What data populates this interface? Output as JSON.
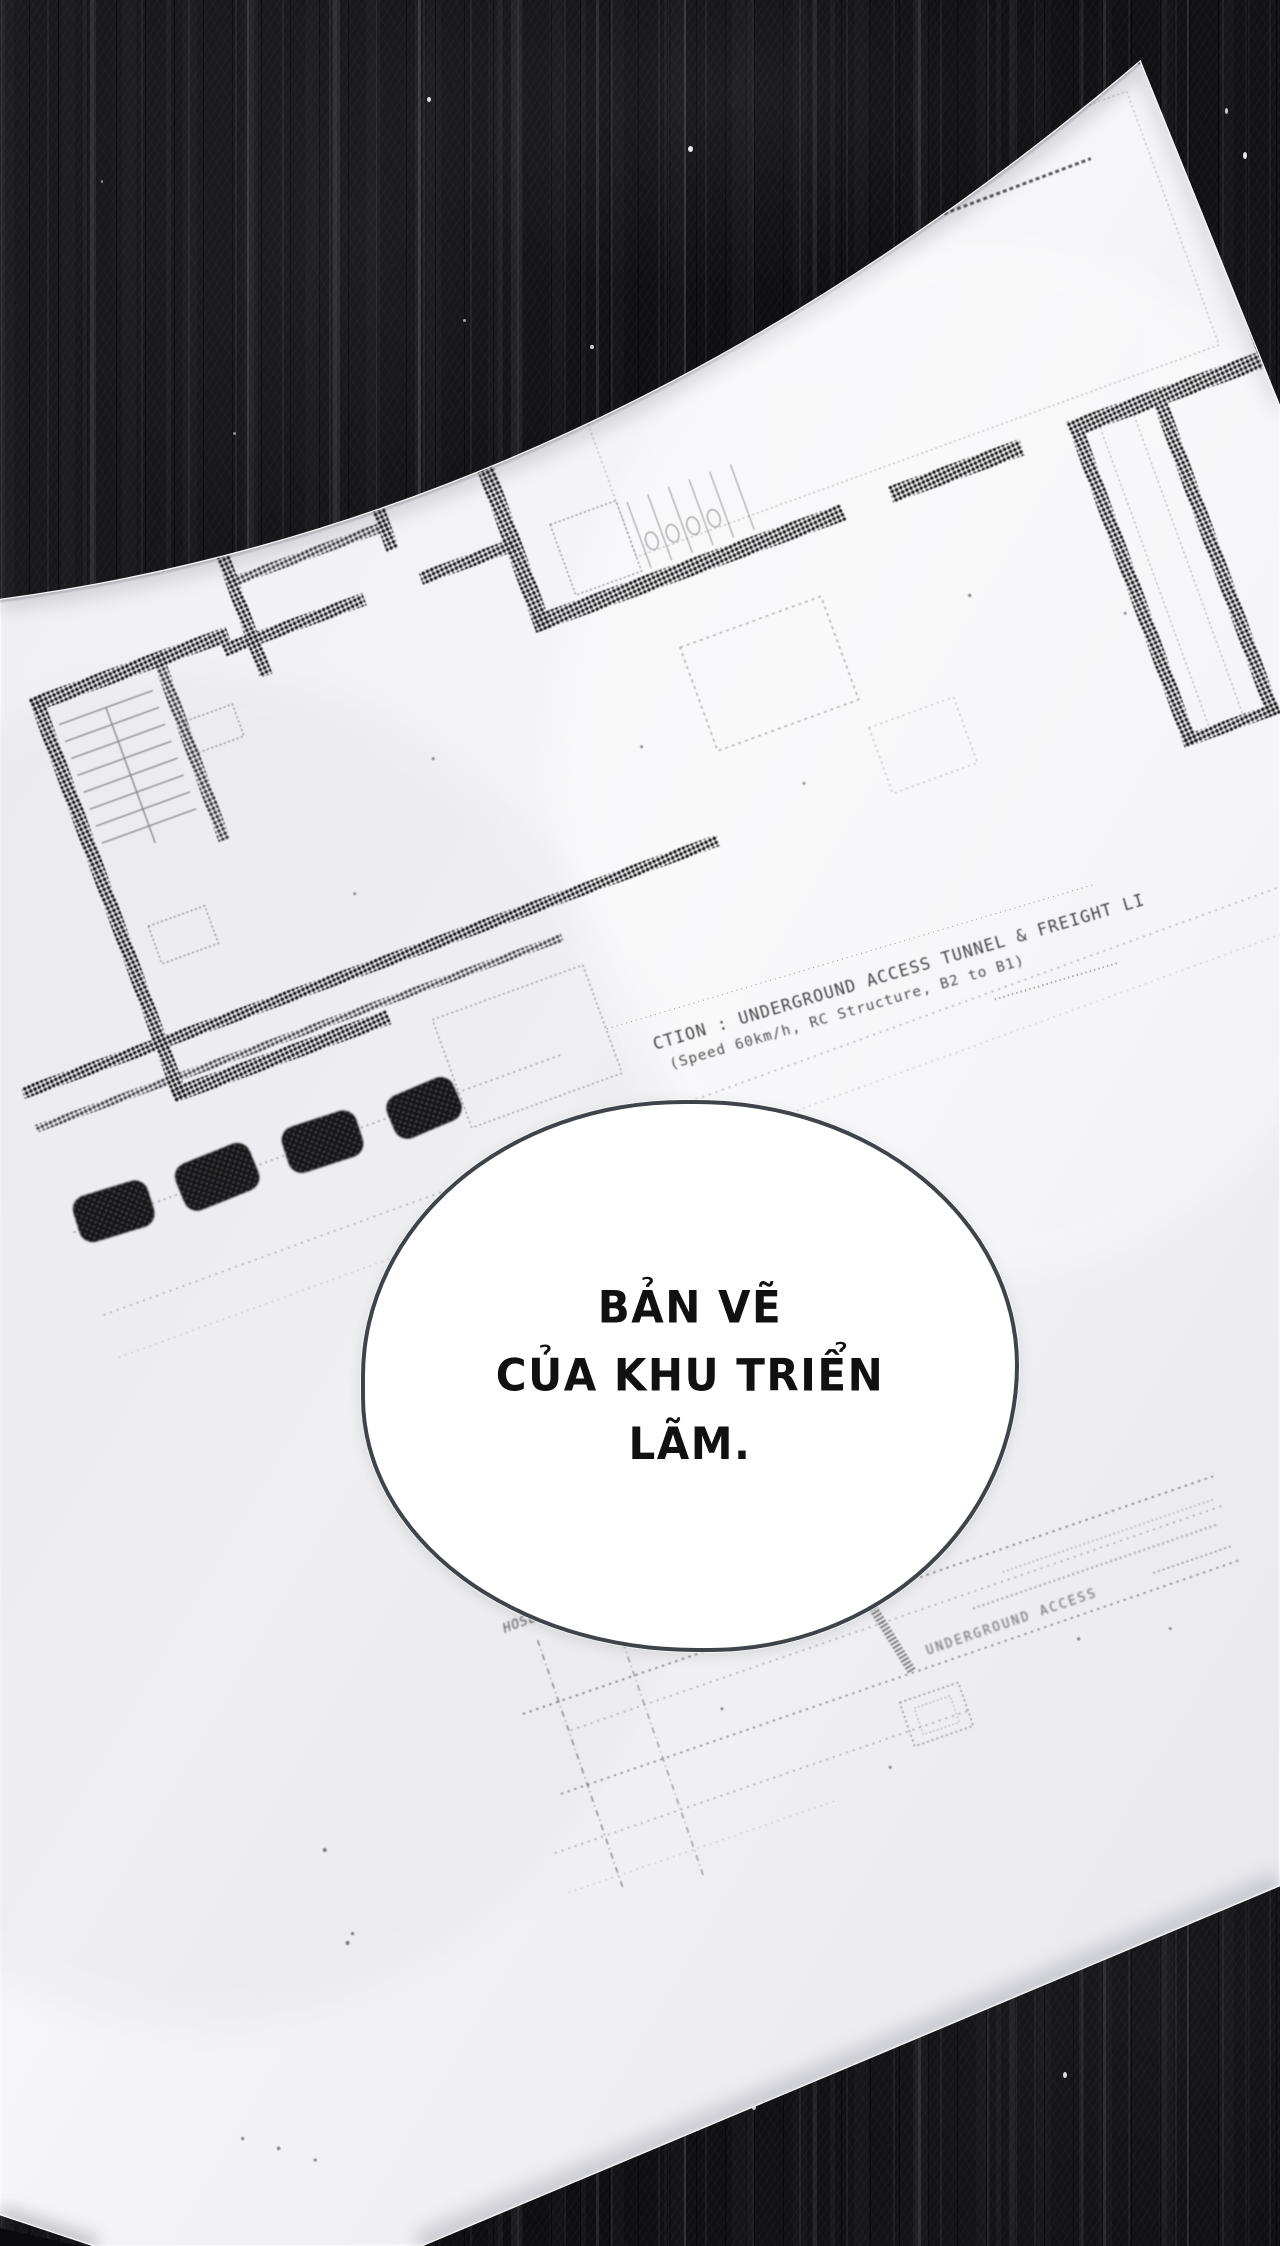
{
  "colors": {
    "background": "#121214",
    "paper": "#f3f3f6",
    "ink": "#17171a",
    "bubble_border": "#3f444b",
    "bubble_fill": "#ffffff",
    "bubble_text": "#111111"
  },
  "speech_bubble": {
    "lines": [
      "BẢN VẼ",
      "CỦA KHU TRIỂN",
      "LÃM."
    ]
  },
  "blueprint": {
    "grid_bubble_count": 14,
    "labels": {
      "tunnel_note_line1": "CTION : UNDERGROUND ACCESS TUNNEL & FREIGHT LI",
      "tunnel_note_line2": "(Speed 60km/h, RC Structure, B2 to B1)",
      "hose_label": "HOSE",
      "section_label": "UNDERGROUND ACCESS"
    }
  }
}
